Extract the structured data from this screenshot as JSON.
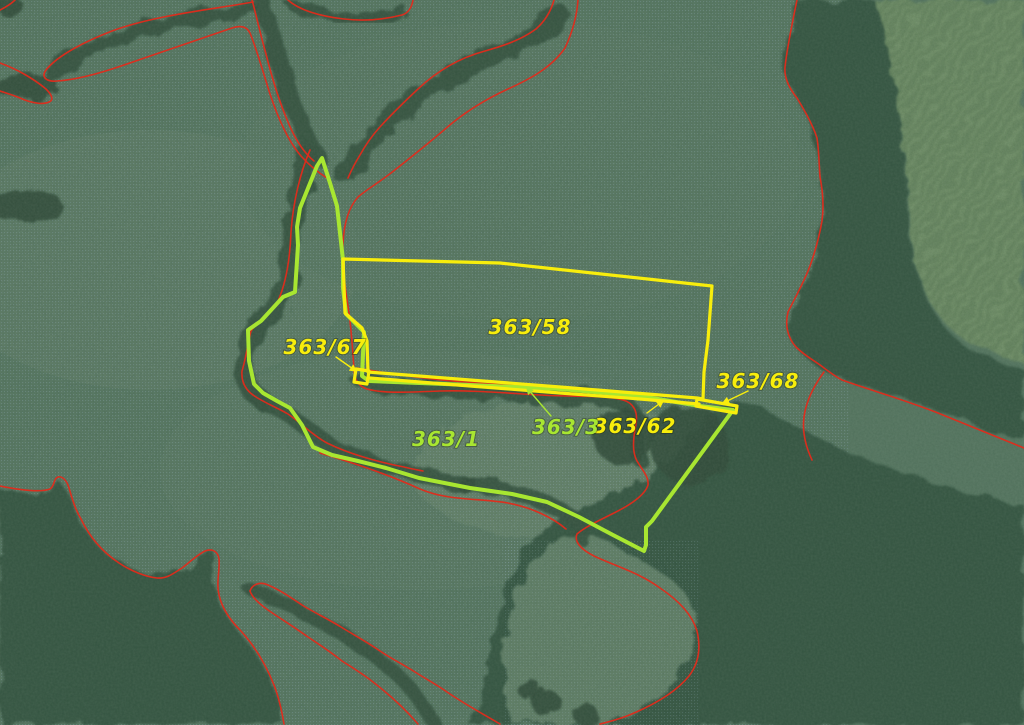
{
  "parcel_labels": [
    {
      "text": "363/58",
      "color": "#f8ed0c"
    },
    {
      "text": "363/67",
      "color": "#f8ed0c"
    },
    {
      "text": "363/68",
      "color": "#f8ed0c"
    },
    {
      "text": "363/62",
      "color": "#f8ed0c"
    },
    {
      "text": "363/3",
      "color": "#a8e631"
    },
    {
      "text": "363/1",
      "color": "#a8e631"
    }
  ],
  "colors": {
    "highlight_parcel_yellow": "#f8ed0c",
    "highlight_parcel_green": "#a8e631",
    "cadastre_boundary_red": "#e12b1b",
    "field_base_green": "#547560",
    "forest_dark_green": "#33523f",
    "raster_grid_dot_blue": "#9db8cc"
  }
}
